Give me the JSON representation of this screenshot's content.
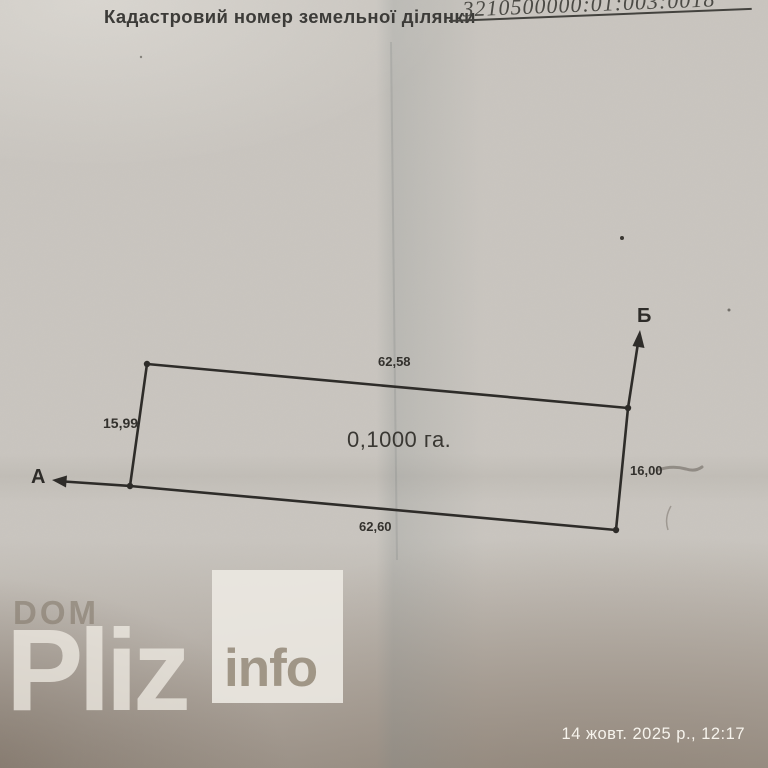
{
  "document": {
    "header_label": "Кадастровий номер земельної ділянки",
    "cadastral_number": "3210500000:01:003:0018"
  },
  "plot": {
    "area_label": "0,1000 га.",
    "dim_top": "62,58",
    "dim_left": "15,99",
    "dim_right": "16,00",
    "dim_bottom": "62,60",
    "point_a": "А",
    "point_b": "Б"
  },
  "watermark": {
    "brand_top": "DOM",
    "brand_main": "Pliz",
    "badge": "info"
  },
  "footer": {
    "timestamp": "14 жовт. 2025 р., 12:17"
  },
  "colors": {
    "paper": "#c9c5bf",
    "ink": "#2e2c29",
    "wm_dark": "rgba(128,116,102,0.55)",
    "wm_light": "rgba(240,236,228,0.75)",
    "badge_bg": "rgba(236,233,226,0.90)",
    "badge_text": "rgba(156,145,130,0.95)",
    "timestamp": "#f6f3ec"
  }
}
